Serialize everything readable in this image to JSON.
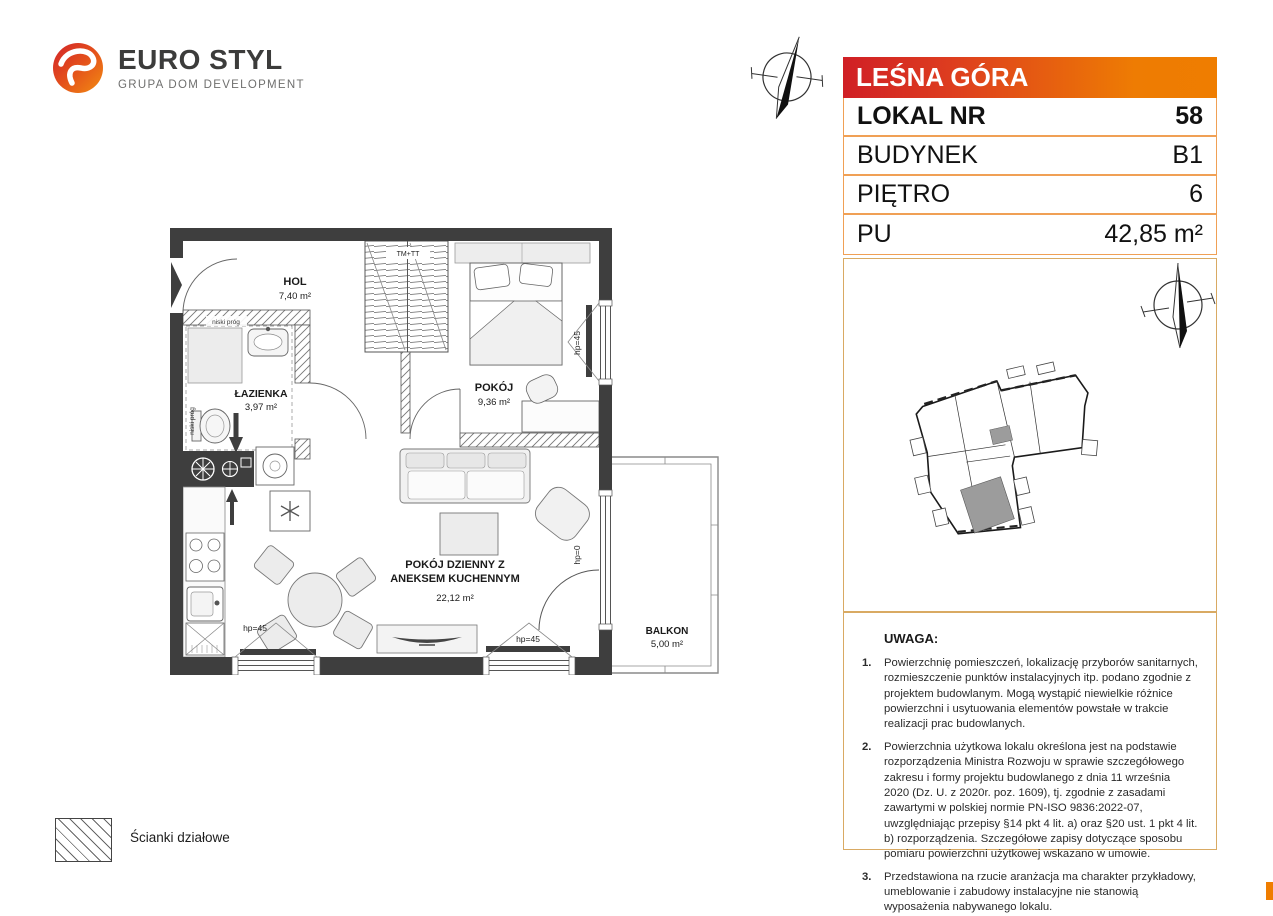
{
  "brand": {
    "name": "EURO STYL",
    "tagline": "GRUPA DOM DEVELOPMENT"
  },
  "header": {
    "project": "LEŚNA GÓRA",
    "rows": [
      {
        "label": "LOKAL NR",
        "value": "58"
      },
      {
        "label": "BUDYNEK",
        "value": "B1"
      },
      {
        "label": "PIĘTRO",
        "value": "6"
      },
      {
        "label": "PU",
        "value": "42,85 m²"
      }
    ]
  },
  "floor_plan": {
    "rooms": {
      "hol": {
        "name": "HOL",
        "area": "7,40 m²"
      },
      "lazienka": {
        "name": "ŁAZIENKA",
        "area": "3,97 m²"
      },
      "pokoj": {
        "name": "POKÓJ",
        "area": "9,36 m²"
      },
      "salon": {
        "name_line1": "POKÓJ DZIENNY Z",
        "name_line2": "ANEKSEM KUCHENNYM",
        "area": "22,12 m²"
      },
      "balkon": {
        "name": "BALKON",
        "area": "5,00 m²"
      }
    },
    "annotations": {
      "tm_tt": "TM+TT",
      "niski_prog_1": "niski próg",
      "niski_prog_2": "niski próg",
      "hp45_bedroom": "hp=45",
      "hp45_window1": "hp=45",
      "hp45_window2": "hp=45",
      "hp0_balcony_door": "hp=0"
    }
  },
  "legend": {
    "partition_walls": "Ścianki działowe"
  },
  "notes": {
    "title": "UWAGA:",
    "items": [
      {
        "num": "1.",
        "text": "Powierzchnię pomieszczeń, lokalizację przyborów sanitarnych, rozmieszczenie punktów instalacyjnych itp. podano zgodnie z projektem budowlanym. Mogą wystąpić niewielkie różnice powierzchni i usytuowania elementów powstałe w trakcie realizacji prac budowlanych."
      },
      {
        "num": "2.",
        "text": "Powierzchnia użytkowa lokalu określona jest na podstawie rozporządzenia Ministra Rozwoju w sprawie szczegółowego zakresu i formy projektu budowlanego z dnia 11 września 2020 (Dz. U. z 2020r. poz. 1609), tj. zgodnie z zasadami zawartymi w polskiej normie PN-ISO 9836:2022-07, uwzględniając przepisy §14 pkt 4 lit. a) oraz §20 ust. 1 pkt 4 lit. b) rozporządzenia. Szczegółowe zapisy dotyczące sposobu pomiaru powierzchni użytkowej wskazano w umowie."
      },
      {
        "num": "3.",
        "text": "Przedstawiona na rzucie aranżacja ma charakter przykładowy, umeblowanie i zabudowy instalacyjne nie stanowią wyposażenia nabywanego lokalu."
      }
    ]
  },
  "colors": {
    "accent_orange": "#ef7d00",
    "accent_red": "#d01f25",
    "wall_dark": "#3e3e3e",
    "box_border_tan": "#d9aa63",
    "highlight_unit_gray": "#9c9c9c"
  }
}
